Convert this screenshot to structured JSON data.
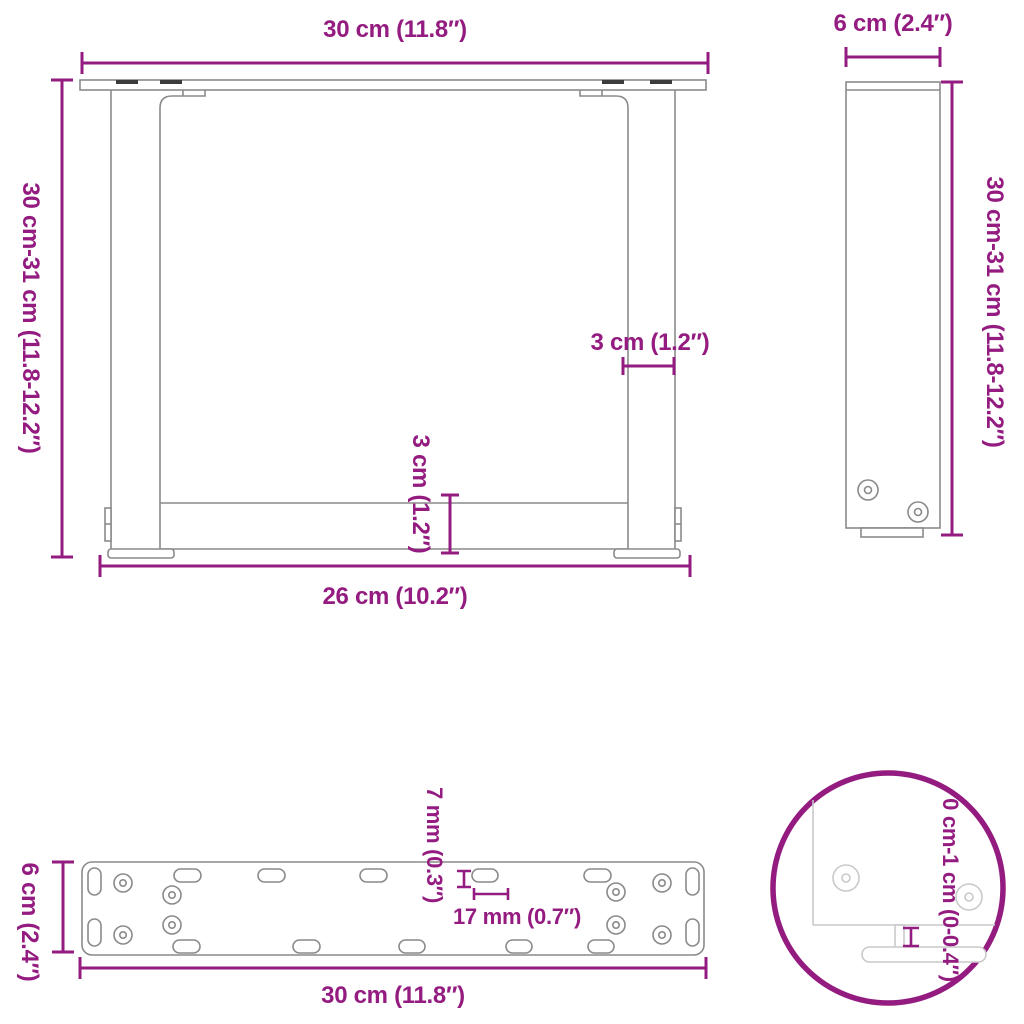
{
  "colors": {
    "dimension": "#941b80",
    "drawing": "#8a8a8a",
    "drawing_light": "#c9c9c9",
    "slot_dark": "#3c3c3c",
    "background": "#ffffff"
  },
  "views": {
    "front": {
      "width_top": "30 cm (11.8″)",
      "height_left": "30 cm-31 cm (11.8-12.2″)",
      "leg_thickness": "3 cm (1.2″)",
      "crossbar_thickness": "3 cm (1.2″)",
      "inner_width_bottom": "26 cm (10.2″)"
    },
    "side": {
      "depth_top": "6 cm (2.4″)",
      "height_right": "30 cm-31 cm (11.8-12.2″)"
    },
    "mounting_plate": {
      "depth_left": "6 cm (2.4″)",
      "width_bottom": "30 cm (11.8″)",
      "slot_height": "7 mm (0.3″)",
      "slot_length": "17 mm (0.7″)"
    },
    "foot_detail": {
      "adjustable_height": "0 cm-1 cm (0-0.4″)"
    }
  }
}
